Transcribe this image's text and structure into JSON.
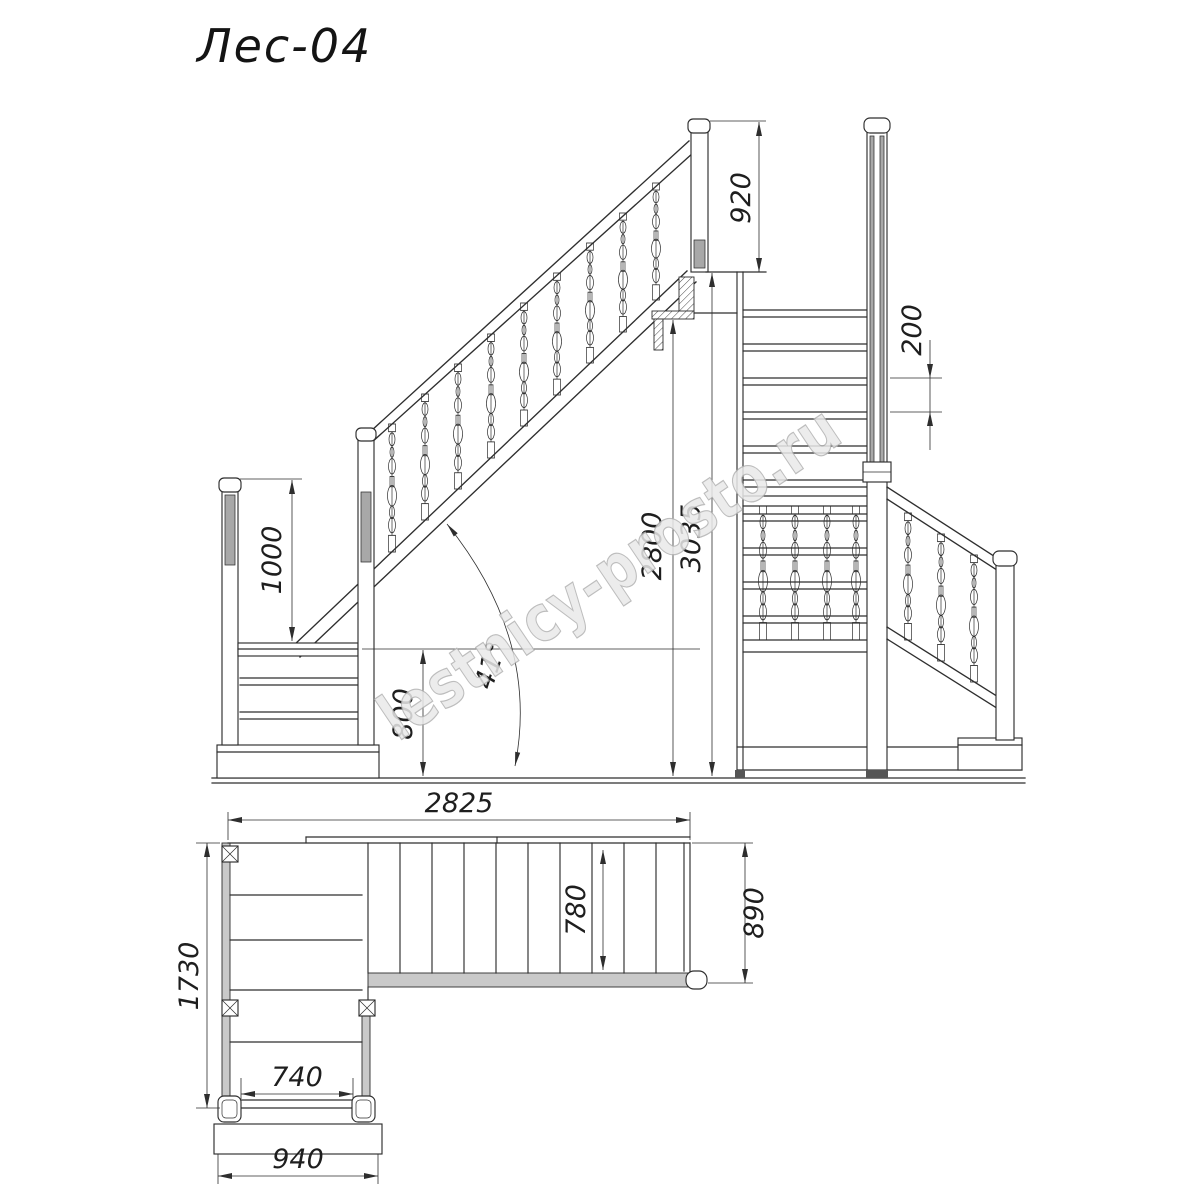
{
  "title": "Лес-04",
  "watermark": "lestnicy-prosto.ru",
  "drawing": {
    "kind": "staircase technical drawing",
    "views": [
      "side elevation",
      "front elevation",
      "plan"
    ]
  },
  "dims": {
    "post_height": "920",
    "landing_rail_height": "1000",
    "landing_height": "800",
    "clear_height": "2800",
    "total_height": "3035",
    "stair_angle": "41°",
    "step_rise": "200",
    "total_length": "2825",
    "flight_width": "890",
    "tread_width": "780",
    "wing_length": "1730",
    "inner_width": "740",
    "outer_width": "940"
  },
  "colors": {
    "line": "#2e2e2e",
    "panel_gray": "#a8a8a8",
    "band_gray": "#c9c9c9",
    "watermark_fill": "#e9e9e9",
    "watermark_stroke": "#b2b2b2"
  }
}
